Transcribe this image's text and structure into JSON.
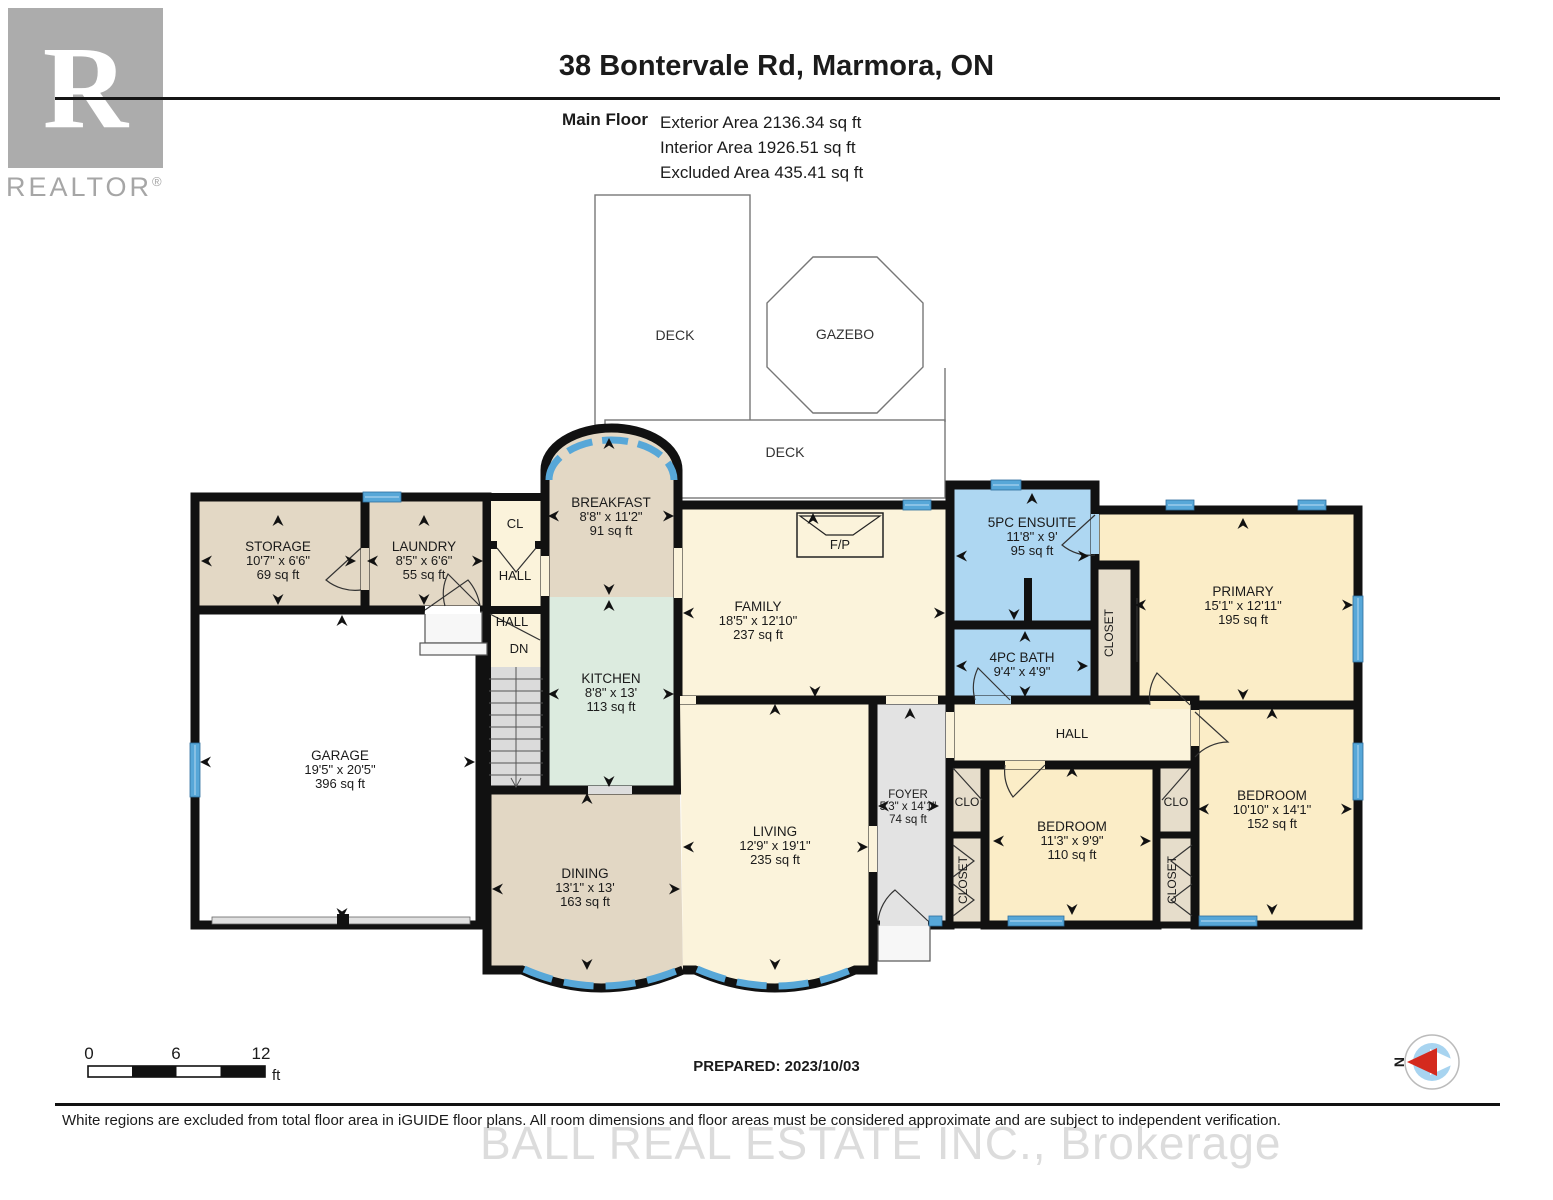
{
  "header": {
    "title": "38 Bontervale Rd, Marmora, ON",
    "floor_label": "Main Floor",
    "exterior_area": "Exterior Area 2136.34 sq ft",
    "interior_area": "Interior Area 1926.51 sq ft",
    "excluded_area": "Excluded Area 435.41 sq ft"
  },
  "logo": {
    "letter": "R",
    "text": "REALTOR",
    "reg": "®"
  },
  "outdoor": {
    "deck_upper": "DECK",
    "gazebo": "GAZEBO",
    "deck_lower": "DECK"
  },
  "rooms": {
    "storage": {
      "name": "STORAGE",
      "dims": "10'7\" x 6'6\"",
      "area": "69 sq ft"
    },
    "laundry": {
      "name": "LAUNDRY",
      "dims": "8'5\" x 6'6\"",
      "area": "55 sq ft"
    },
    "garage": {
      "name": "GARAGE",
      "dims": "19'5\" x 20'5\"",
      "area": "396 sq ft"
    },
    "breakfast": {
      "name": "BREAKFAST",
      "dims": "8'8\" x 11'2\"",
      "area": "91 sq ft"
    },
    "kitchen": {
      "name": "KITCHEN",
      "dims": "8'8\" x 13'",
      "area": "113 sq ft"
    },
    "family": {
      "name": "FAMILY",
      "dims": "18'5\" x 12'10\"",
      "area": "237 sq ft"
    },
    "ensuite": {
      "name": "5PC ENSUITE",
      "dims": "11'8\" x 9'",
      "area": "95 sq ft"
    },
    "bath": {
      "name": "4PC BATH",
      "dims": "9'4\" x 4'9\""
    },
    "primary": {
      "name": "PRIMARY",
      "dims": "15'1\" x 12'11\"",
      "area": "195 sq ft"
    },
    "foyer": {
      "name": "FOYER",
      "dims": "5'3\" x 14'1\"",
      "area": "74 sq ft"
    },
    "bedroom_mid": {
      "name": "BEDROOM",
      "dims": "11'3\" x 9'9\"",
      "area": "110 sq ft"
    },
    "bedroom_right": {
      "name": "BEDROOM",
      "dims": "10'10\" x 14'1\"",
      "area": "152 sq ft"
    },
    "dining": {
      "name": "DINING",
      "dims": "13'1\" x 13'",
      "area": "163 sq ft"
    },
    "living": {
      "name": "LIVING",
      "dims": "12'9\" x 19'1\"",
      "area": "235 sq ft"
    }
  },
  "labels": {
    "cl": "CL",
    "hall": "HALL",
    "dn": "DN",
    "clo": "CLO",
    "closet": "CLOSET",
    "fireplace": "F/P",
    "north": "N"
  },
  "scale": {
    "zero": "0",
    "six": "6",
    "twelve": "12",
    "unit": "ft"
  },
  "footer": {
    "prepared": "PREPARED: 2023/10/03",
    "disclaimer": "White regions are excluded from total floor area in iGUIDE floor plans. All room dimensions and floor areas must be considered approximate and are subject to independent verification.",
    "watermark": "BALL REAL ESTATE INC., Brokerage"
  },
  "colors": {
    "wall": "#111111",
    "window": "#57A7D8",
    "window_light": "#9CCBEA",
    "beige": "#E3D8C5",
    "cream": "#FBF3DB",
    "yellow": "#FBEDC7",
    "mint": "#DCEBDF",
    "blue": "#AED7F2",
    "closet_tan": "#E6DDCB",
    "foyer_gray": "#E3E3E3",
    "stairs_gray": "#DBDBDB",
    "compass_red": "#D42A1E"
  }
}
